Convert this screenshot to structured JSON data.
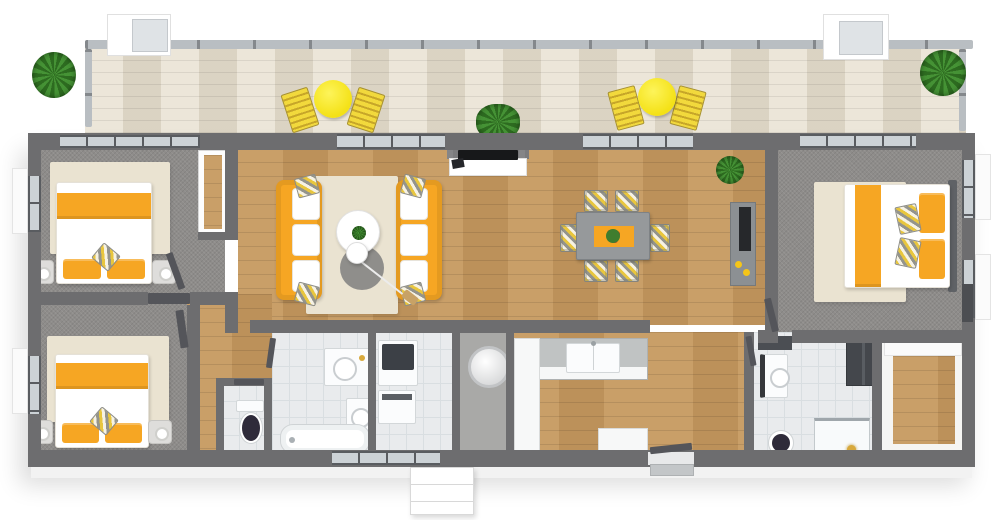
{
  "scene": {
    "kind": "floor-plan-3d-top-view",
    "text_labels_visible": "none"
  },
  "palette": {
    "background": "#ffffff",
    "wall": "#6d6d6f",
    "wall_dark": "#54555a",
    "deck_wood": "#e4dccb",
    "floor_wood": "#c6995f",
    "carpet": "#8e8c8a",
    "tile": "#e9ebed",
    "tile_line": "#d9dee1",
    "rug_cream": "#eae3d1",
    "rug_gray": "#7f7f7f",
    "accent_orange": "#f6a623",
    "accent_yellow": "#f4e116",
    "glass": "#ccd2d6",
    "counter_gray": "#c0c3c3",
    "fixture_white": "#fbfcfd",
    "toilet_navy": "#2f2b3a",
    "plant_green": "#3e7d2d",
    "gold": "#d8a93c",
    "table_gray": "#96999b",
    "console_gray": "#8c9093",
    "headboard_gray": "#5f6266"
  },
  "floorplan": {
    "deck": {
      "name": "deck",
      "floor": "whitewashed wood planks",
      "items": [
        "potted plant",
        "yellow bistro table",
        "two yellow lounge chairs",
        "green shrub",
        "yellow bistro table",
        "two yellow lounge chairs",
        "palm plant",
        "guard railing",
        "roof box skylight",
        "roof box skylight"
      ]
    },
    "rooms": [
      {
        "name": "bedroom-top-left",
        "floor": "gray carpet",
        "items": [
          "double bed with orange bedding",
          "two nightstands with lamps",
          "cream area rug",
          "closet",
          "door"
        ]
      },
      {
        "name": "bedroom-bottom-left",
        "floor": "gray carpet",
        "items": [
          "double bed with orange bedding",
          "two nightstands with lamps",
          "cream area rug",
          "door"
        ]
      },
      {
        "name": "living-room",
        "floor": "oak hardwood",
        "items": [
          "orange sofa",
          "orange sofa",
          "round white coffee table with plant",
          "round gray rug",
          "arc floor lamp",
          "cream area rug",
          "tv console",
          "flat tv"
        ]
      },
      {
        "name": "dining-room",
        "floor": "oak hardwood",
        "items": [
          "gray dining table",
          "orange table runner with red flowers",
          "six chevron-pattern chairs",
          "tall sideboard with fruit",
          "potted plant"
        ]
      },
      {
        "name": "kitchen",
        "floor": "oak hardwood",
        "items": [
          "u-shaped counter",
          "double sink"
        ]
      },
      {
        "name": "wc",
        "floor": "white tile",
        "items": [
          "toilet with dark lid"
        ]
      },
      {
        "name": "bathroom",
        "floor": "white tile",
        "items": [
          "vanity sink",
          "vanity sink",
          "bathtub"
        ]
      },
      {
        "name": "laundry",
        "floor": "white tile",
        "items": [
          "washer",
          "dryer"
        ]
      },
      {
        "name": "utility-closet",
        "floor": "gray",
        "items": [
          "water heater cylinder"
        ]
      },
      {
        "name": "hallway-left",
        "floor": "oak hardwood",
        "items": []
      },
      {
        "name": "hallway-right",
        "floor": "oak hardwood",
        "items": [
          "entry door",
          "entry mat"
        ]
      },
      {
        "name": "master-bedroom",
        "floor": "gray carpet",
        "items": [
          "double bed with orange bedding",
          "dark headboard",
          "cream area rug"
        ]
      },
      {
        "name": "ensuite-bathroom",
        "floor": "white tile",
        "items": [
          "vanity sink",
          "mirror cabinet",
          "toilet with dark lid",
          "shower with gold fixture",
          "dark wardrobe units"
        ]
      },
      {
        "name": "walk-in-closet",
        "floor": "oak hardwood inset",
        "items": [
          "white wardrobe units"
        ]
      }
    ],
    "exterior": {
      "items": [
        "entry steps",
        "glazed sliding doors",
        "windows with outer sills"
      ]
    }
  }
}
